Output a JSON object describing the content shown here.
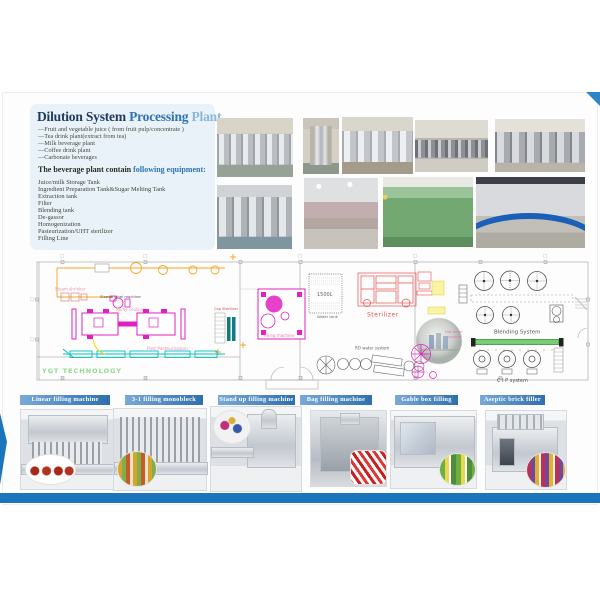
{
  "page": {
    "title": {
      "lead": "Dilution System ",
      "mid": "Processing ",
      "tail": "Plant"
    },
    "intro_items": [
      "—Fruit and vegetable juice ( from fruit pulp/concentrate )",
      "—Tea drink plant(extract from tea)",
      "—Milk beverage plant",
      "—Coffee drink plant",
      "—Carbonate beverages"
    ],
    "equipment_heading": {
      "dark": "The beverage plant contain ",
      "blue": "following equipment:"
    },
    "equipment_items": [
      "Juice/milk Storage Tank",
      "Ingredient Preparation Tank&Sugar Melting Tank",
      "Extraction tank",
      "Filter",
      "Blending tank",
      "De-gassor",
      "Homogenization",
      "Pasteurization/UHT sterilizer",
      "Filling Line"
    ]
  },
  "diagram": {
    "steam_shrinker": "Steam shrinker",
    "sleeve_label_machine": "Sleeve label machine",
    "spray_cooling": "Spray cooling",
    "post_pasteurization": "Post Pasteurization",
    "cap_sterilizer": "Cap Sterilizer",
    "filling_machine": "Filling machine",
    "tank_capacity": "1500L",
    "water_tank": "Water tank",
    "sterilizer": "Sterilizer",
    "ro_water_system": "RO water system",
    "blending_system": "Blending System",
    "hot_water_line1": "Hot water",
    "hot_water_line2": "system",
    "cip_system": "C I P system",
    "company": "YGT  TECHNOLOGY"
  },
  "machines": [
    {
      "label": "Linear filling machine"
    },
    {
      "label": "3-1 filling monoblock"
    },
    {
      "label": "Stand up filling machine"
    },
    {
      "label": "Bag filling machine"
    },
    {
      "label": "Gable box filling"
    },
    {
      "label": "Aseptic brick filler"
    }
  ],
  "colors": {
    "accent_blue": "#1b75bc",
    "banner_blue": "#3a7ab8",
    "title_navy": "#1d3a5f",
    "title_blue": "#2e74b5",
    "magenta": "#e020c0",
    "orange": "#f2a71f",
    "cyan": "#00c2c2",
    "sterilizer_red": "#e35050",
    "green_bar": "#72d072",
    "company_green": "#8fd98f"
  }
}
